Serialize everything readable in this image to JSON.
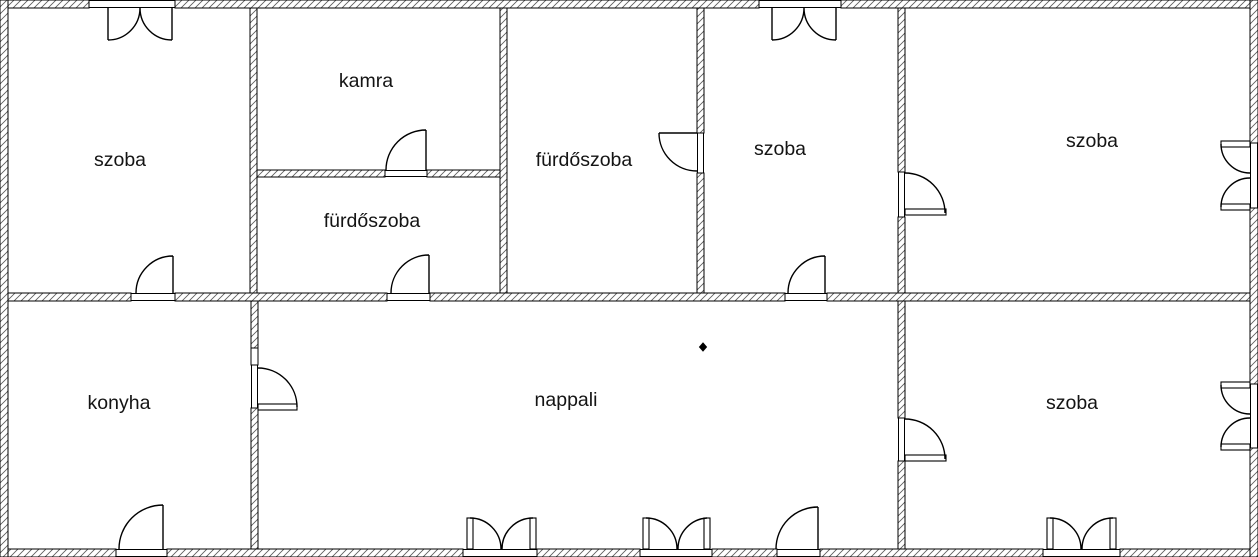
{
  "floor_plan": {
    "language": "Hungarian",
    "rooms": [
      {
        "id": "szoba-top-left",
        "label": "szoba"
      },
      {
        "id": "kamra",
        "label": "kamra"
      },
      {
        "id": "furdoszoba-small",
        "label": "fürdőszoba"
      },
      {
        "id": "furdoszoba-main",
        "label": "fürdőszoba"
      },
      {
        "id": "szoba-top-middle",
        "label": "szoba"
      },
      {
        "id": "szoba-top-right",
        "label": "szoba"
      },
      {
        "id": "konyha",
        "label": "konyha"
      },
      {
        "id": "nappali",
        "label": "nappali"
      },
      {
        "id": "szoba-bottom-right",
        "label": "szoba"
      }
    ],
    "colors": {
      "wall_outline": "#000000",
      "background": "#ffffff",
      "label": "#141414"
    },
    "symbols": [
      {
        "id": "nappali-diamond-marker",
        "type": "diamond"
      }
    ]
  }
}
